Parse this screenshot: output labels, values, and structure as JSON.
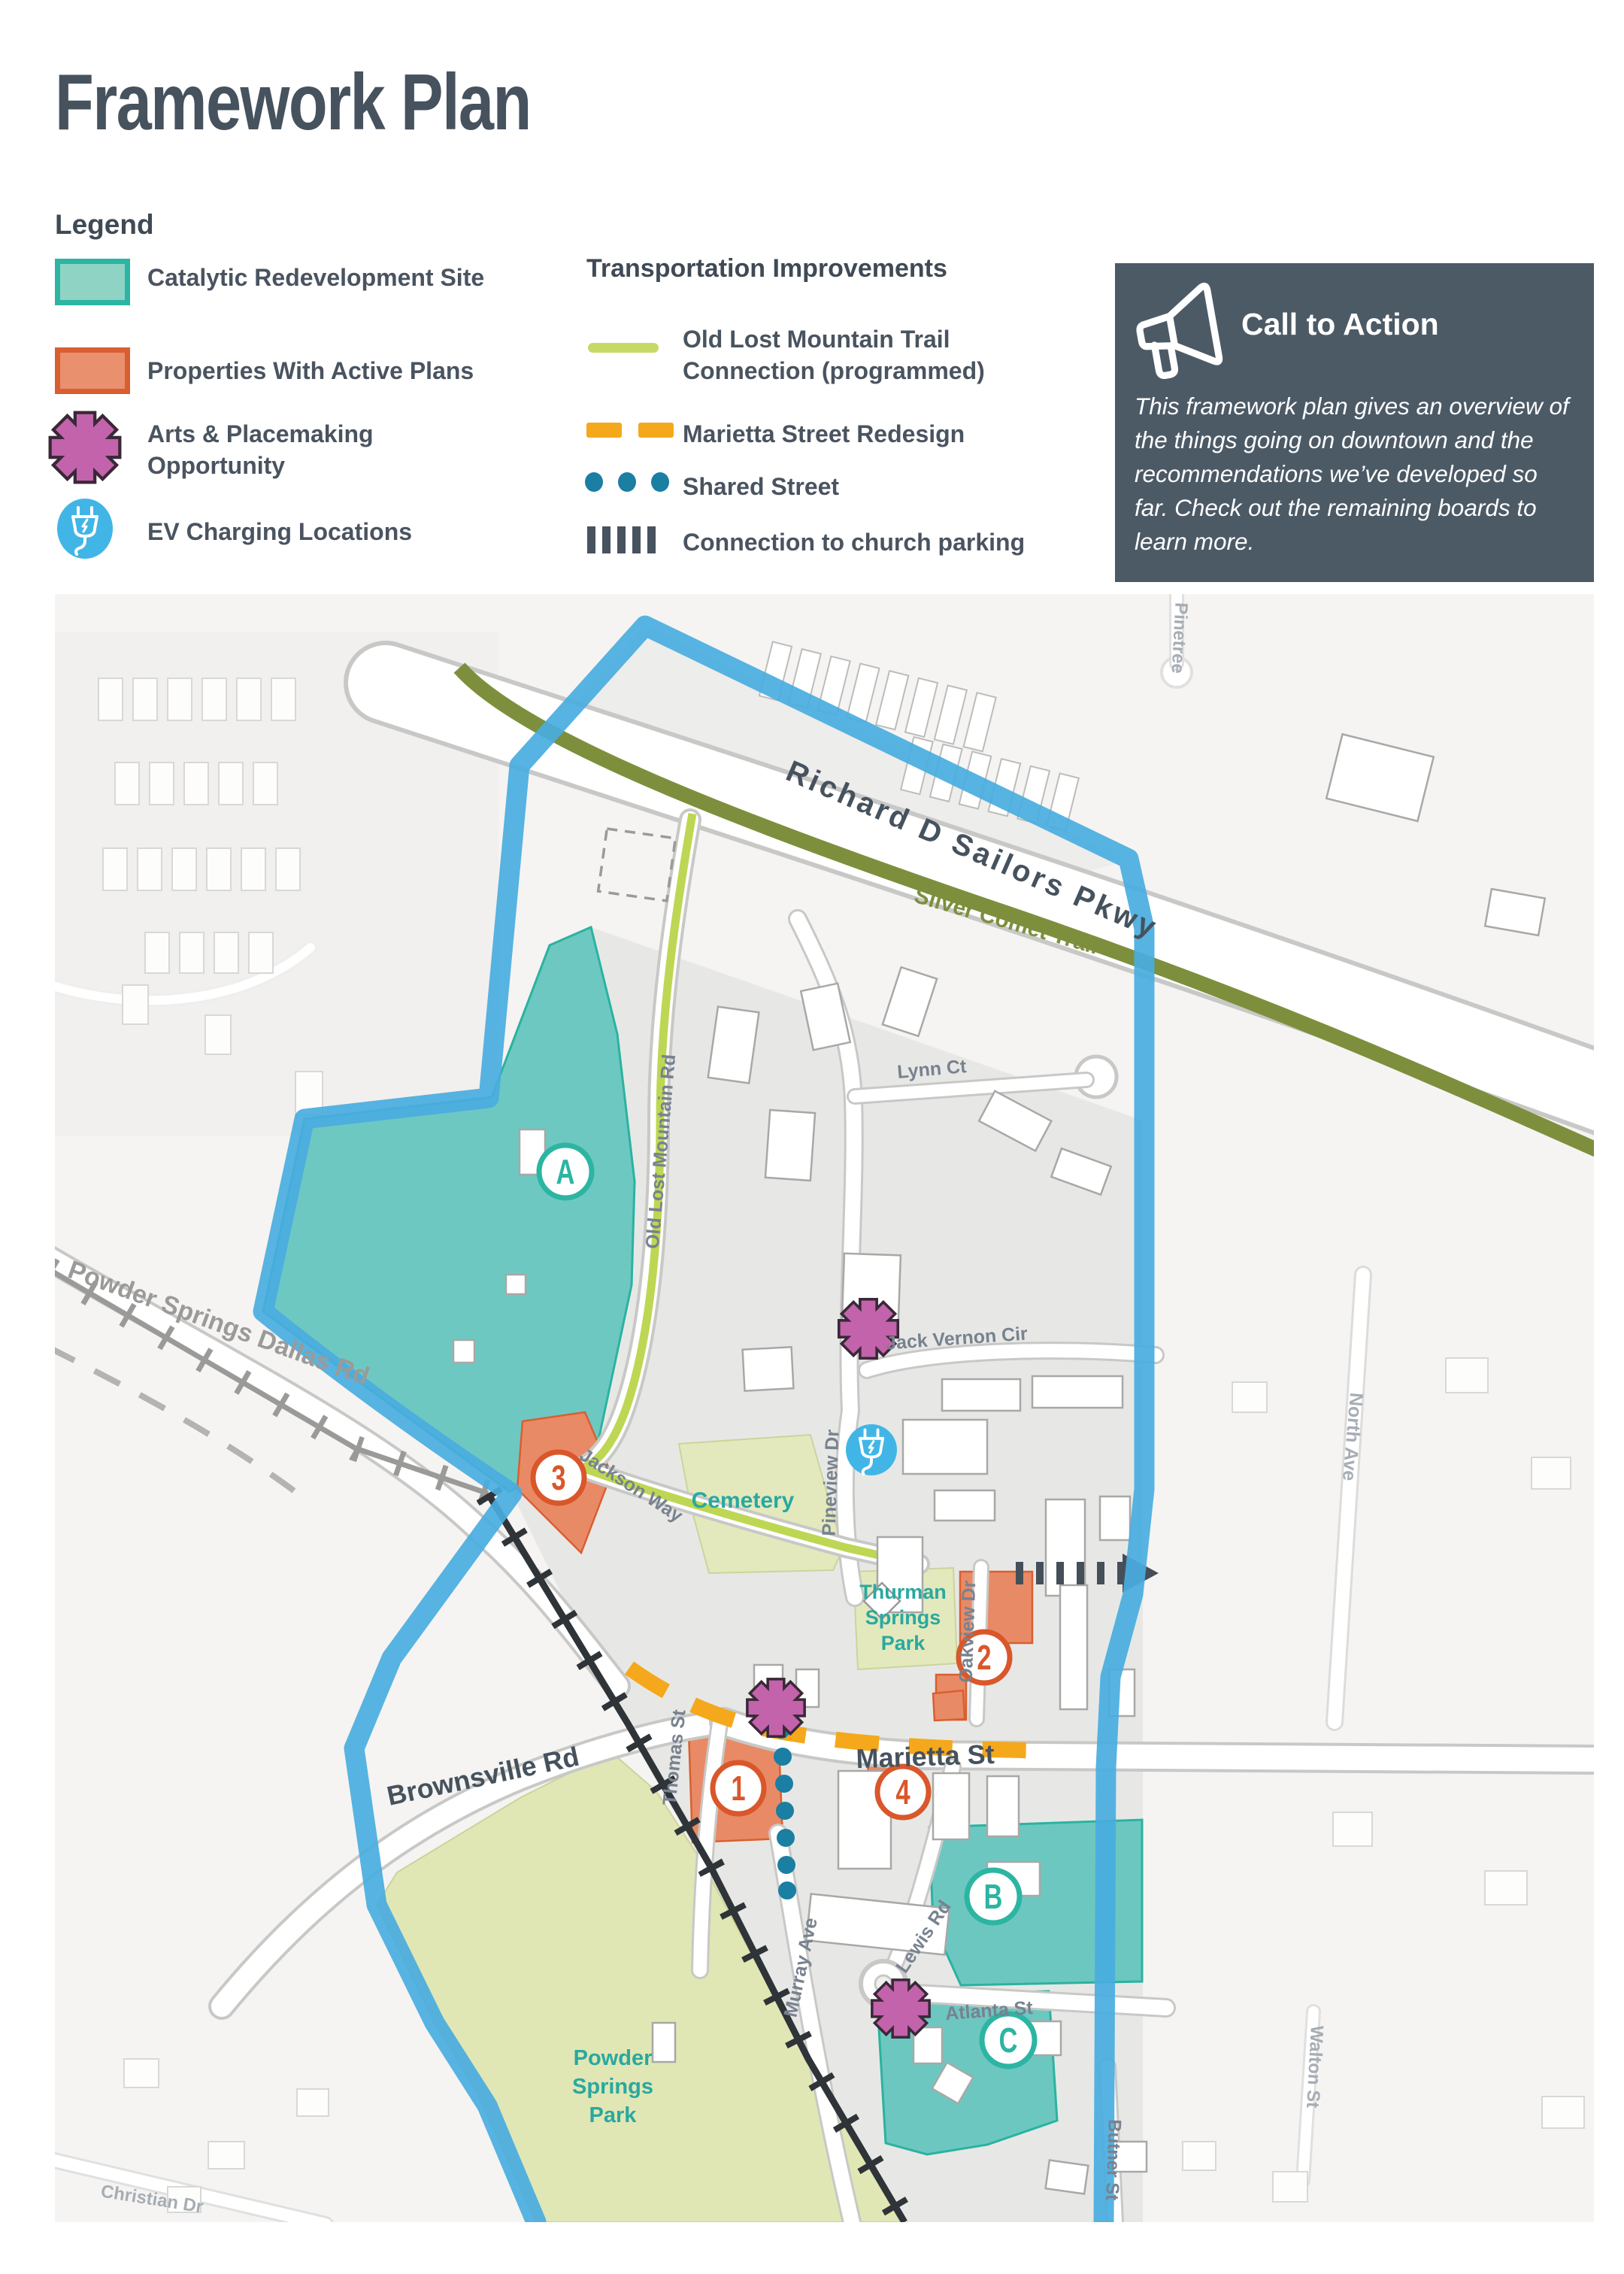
{
  "page": {
    "title": "Framework Plan"
  },
  "legend": {
    "heading": "Legend",
    "items": [
      {
        "name": "catalytic-redevelopment-site",
        "label": "Catalytic Redevelopment Site",
        "fill": "#8ed3c4",
        "border": "#2cb5a2"
      },
      {
        "name": "properties-with-active-plans",
        "label": "Properties With Active Plans",
        "fill": "#e9906e",
        "border": "#d95f30"
      },
      {
        "name": "arts-placemaking-opportunity",
        "label": "Arts & Placemaking Opportunity",
        "color": "#c263ab"
      },
      {
        "name": "ev-charging-locations",
        "label": "EV Charging Locations",
        "color": "#41b6e6"
      }
    ]
  },
  "transportation": {
    "heading": "Transportation Improvements",
    "items": [
      {
        "name": "old-lost-mountain-trail-connection",
        "label": "Old Lost Mountain Trail Connection (programmed)",
        "color": "#c6d964",
        "style": "solid-line"
      },
      {
        "name": "marietta-street-redesign",
        "label": "Marietta Street Redesign",
        "color": "#f5a81c",
        "style": "dashed-line"
      },
      {
        "name": "shared-street",
        "label": "Shared Street",
        "color": "#1b7ea3",
        "style": "dotted-line"
      },
      {
        "name": "connection-to-church-parking",
        "label": "Connection to church parking",
        "color": "#47535e",
        "style": "tick-line"
      }
    ]
  },
  "call_to_action": {
    "heading": "Call to Action",
    "body": "This framework plan gives an overview of the things going on downtown and the recommendations we’ve developed so far. Check out the remaining boards to learn more."
  },
  "map": {
    "labels": {
      "pkwy": "Richard D Sailors Pkwy",
      "silver_comet": "Silver Comet Trail",
      "lynn_ct": "Lynn Ct",
      "old_lost_mountain_rd": "Old Lost Mountain Rd",
      "powder_springs_dallas_rd": "Powder Springs Dallas Rd",
      "jack_vernon_cir": "Jack Vernon Cir",
      "pineview_dr": "Pineview Dr",
      "jackson_way": "Jackson Way",
      "cemetery": "Cemetery",
      "oakview_dr": "Oakview Dr",
      "marietta_st": "Marietta St",
      "brownsville_rd": "Brownsville Rd",
      "thomas_st": "Thomas St",
      "murray_ave": "Murray Ave",
      "lewis_rd": "Lewis Rd",
      "atlanta_st": "Atlanta St",
      "north_ave": "North Ave",
      "walton_st": "Walton St",
      "butner_st": "Butner St",
      "christian_dr": "Christian Dr",
      "pinetree": "Pinetree",
      "thurman_springs_park": {
        "line1": "Thurman",
        "line2": "Springs",
        "line3": "Park"
      },
      "powder_springs_park": {
        "line1": "Powder",
        "line2": "Springs",
        "line3": "Park"
      }
    },
    "markers": {
      "sites": [
        {
          "label": "A"
        },
        {
          "label": "B"
        },
        {
          "label": "C"
        }
      ],
      "parcels": [
        {
          "label": "1"
        },
        {
          "label": "2"
        },
        {
          "label": "3"
        },
        {
          "label": "4"
        }
      ]
    },
    "colors": {
      "boundary": "#49ade0",
      "catalytic_site": "#5fc3bc",
      "active_plan_parcel": "#e98a66",
      "trail": "#7d8f3d",
      "trail_connection": "#bdd754",
      "park": "#e3e9bd"
    }
  }
}
